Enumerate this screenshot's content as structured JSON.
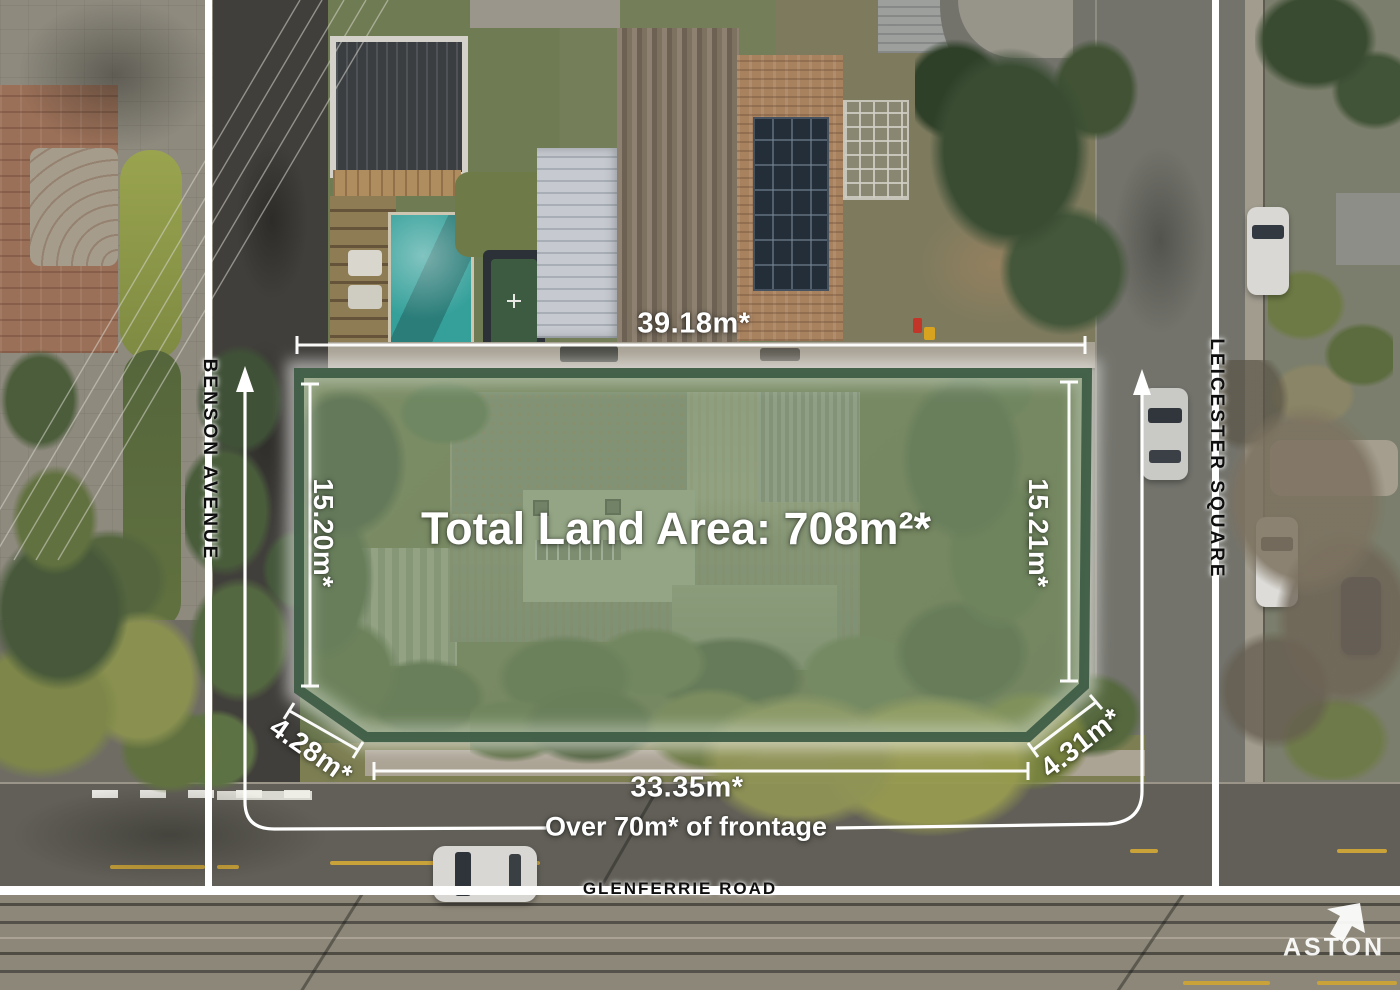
{
  "property_overlay": {
    "total_land_area": "Total Land Area: 708m²*",
    "top_boundary": "39.18m*",
    "left_boundary": "15.20m*",
    "right_boundary": "15.21m*",
    "bottom_boundary": "33.35m*",
    "bottom_left_splay": "4.28m*",
    "bottom_right_splay": "4.31m*",
    "frontage_note": "Over 70m* of frontage"
  },
  "road_labels": {
    "left": "BENSON AVENUE",
    "right": "LEICESTER SQUARE",
    "bottom": "GLENFERRIE ROAD"
  },
  "branding": {
    "agency": "ASTON"
  },
  "colors": {
    "plot_fill": "rgba(140,163,126,0.46)",
    "plot_border": "#3c5a44",
    "annotation_text": "#ffffff",
    "road_label_text": "#0e0e0e"
  }
}
